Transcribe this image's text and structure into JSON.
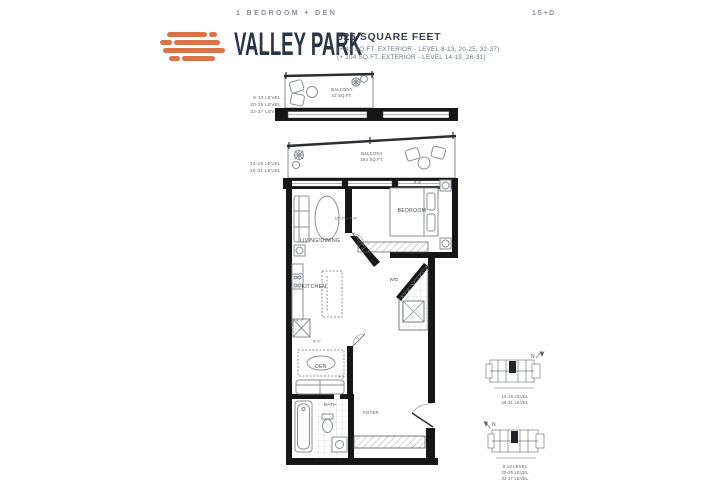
{
  "header": {
    "unit_type": "1 BEDROOM + DEN",
    "brand": "VALLEY PARK",
    "area": "625 SQUARE FEET",
    "exterior_note_1": "(+ 42 SQ.FT. EXTERIOR - LEVEL 8-13, 20-25, 32-37)",
    "exterior_note_2": "(+ 104 SQ.FT. EXTERIOR - LEVEL 14-19, 26-31)",
    "unit_code": "1S+D",
    "brand_color": "#DC7348",
    "text_color": "#2B3442"
  },
  "upper_plan": {
    "levels": [
      "8-13 LEVEL",
      "20-25 LEVEL",
      "32-37 LEVEL"
    ],
    "balcony_label": "BALCONY",
    "balcony_area": "42 SQ.FT."
  },
  "main_plan": {
    "levels": [
      "14-19 LEVEL",
      "26-31 LEVEL"
    ],
    "balcony_label": "BALCONY",
    "balcony_area": "104 SQ.FT.",
    "rooms": {
      "living": "LIVING/DINING",
      "bedroom": "BEDROOM",
      "kitchen": "KITCHEN",
      "den": "DEN",
      "bath": "BATH",
      "foyer": "FOYER",
      "laundry": "W/D"
    },
    "dimensions": {
      "living": "10'-2\" x 9'-9\"",
      "bedroom": "8'-8\"",
      "den": "8'-2\"",
      "den_width": "7'-1\"",
      "kitchen": "4'-2\""
    }
  },
  "keyplans": [
    {
      "north": "N",
      "levels": [
        "14-19 LEVEL",
        "26-31 LEVEL"
      ]
    },
    {
      "north": "N",
      "levels": [
        "8-13 LEVEL",
        "20-25 LEVEL",
        "32-37 LEVEL"
      ]
    }
  ]
}
